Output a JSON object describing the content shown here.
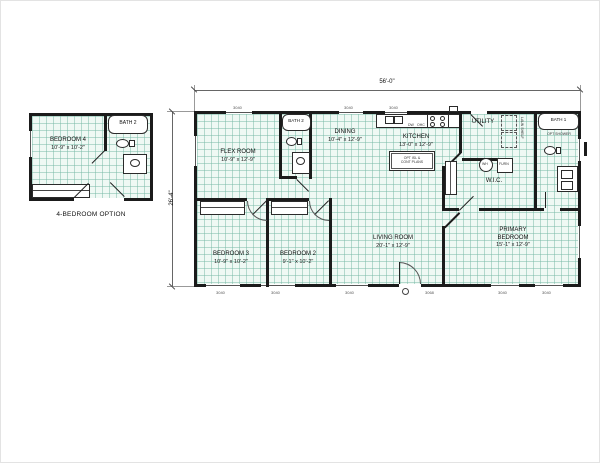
{
  "dims": {
    "width": "56'-0\"",
    "height": "26'-4\""
  },
  "inset": {
    "caption": "4-BEDROOM OPTION",
    "bedroom4": {
      "name": "BEDROOM 4",
      "size": "10'-9\" x 10'-2\""
    },
    "bath2": {
      "name": "BATH 2"
    }
  },
  "rooms": {
    "flex": {
      "name": "FLEX ROOM",
      "size": "10'-9\" x 12'-9\""
    },
    "bath2": {
      "name": "BATH 2"
    },
    "dining": {
      "name": "DINING",
      "size": "10'-4\" x 12'-9\""
    },
    "kitchen": {
      "name": "KITCHEN",
      "size": "13'-0\" x 12'-9\""
    },
    "utility": {
      "name": "UTILITY"
    },
    "bath1": {
      "name": "BATH 1"
    },
    "wic": {
      "name": "W.I.C."
    },
    "living": {
      "name": "LIVING ROOM",
      "size": "20'-1\" x 12'-9\""
    },
    "primary": {
      "line1": "PRIMARY",
      "line2": "BEDROOM",
      "size": "15'-1\" x 12'-9\""
    },
    "bed2": {
      "name": "BEDROOM 2",
      "size": "9'-1\" x 10'-2\""
    },
    "bed3": {
      "name": "BEDROOM 3",
      "size": "10'-9\" x 10'-2\""
    }
  },
  "fixtures": {
    "wh": "WH",
    "furn": "FURN",
    "dw": "DW",
    "ohc": "OHC",
    "laundry_shelf": "LAUN SHELF",
    "shower_note": "OPT SHOWER",
    "island_note_1": "OPT ISL &",
    "island_note_2": "CONT PLANS"
  },
  "labels": {
    "window": "3040",
    "door": "3068"
  },
  "colors": {
    "wall": "#1b1b1b",
    "floor_grid": "#78b9a5",
    "floor_fill": "#eff9f4"
  }
}
